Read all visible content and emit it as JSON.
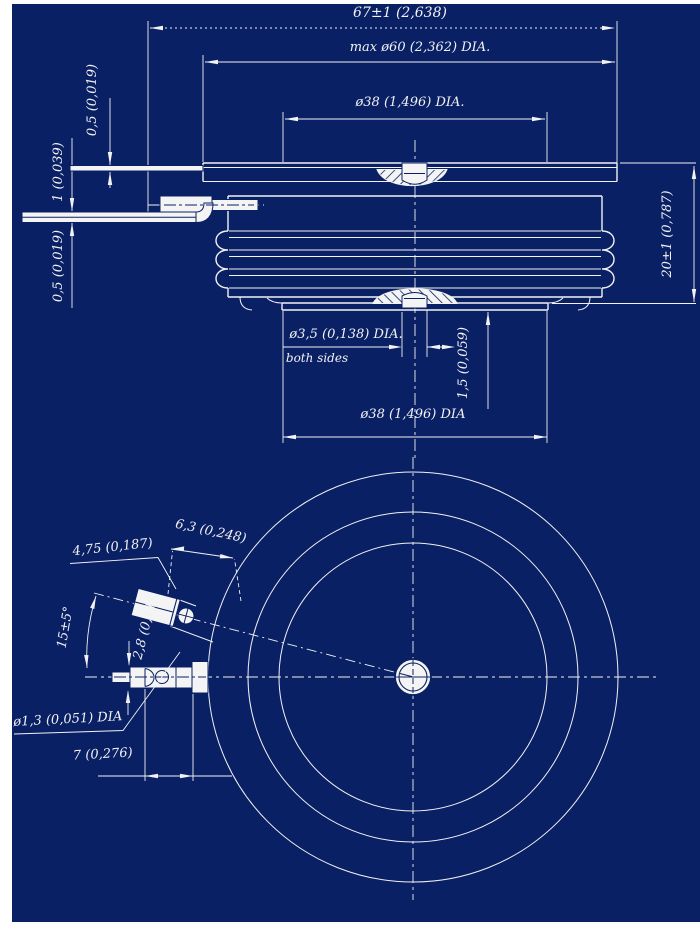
{
  "colors": {
    "background": "#0a2065",
    "line": "#f2f2f2",
    "metal": "#f4f4f4",
    "margin": "#ffffff"
  },
  "drawing": {
    "type": "technical-drawing",
    "subject": "disc (puck) style semiconductor package, section view and bottom view"
  },
  "labels": {
    "overall_width": "67±1 (2,638)",
    "max_dia": "max ø60 (2,362) DIA.",
    "pole_dia_top": "ø38 (1,496) DIA.",
    "lead_thickness_top": "0,5 (0,019)",
    "lead_thickness_mid": "1 (0,039)",
    "lead_thickness_bottom": "0,5 (0,019)",
    "height": "20±1 (0,787)",
    "center_hole_dia": "ø3,5 (0,138) DIA.",
    "center_hole_note": "both sides",
    "recess_offset": "1,5 (0,059)",
    "pole_dia_bottom": "ø38 (1,496) DIA",
    "tab_length": "6,3 (0,248)",
    "tab_width": "4,75 (0,187)",
    "lead_angle": "15±5°",
    "terminal_thickness": "2,8 (0,11)",
    "hole_dia": "ø1,3 (0,051) DIA",
    "hole_offset": "7 (0,276)"
  }
}
